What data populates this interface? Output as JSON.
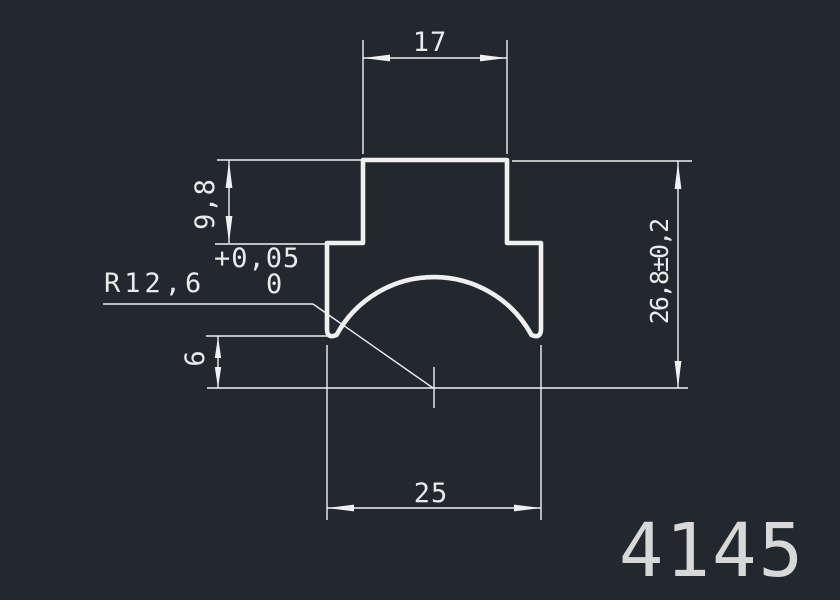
{
  "colors": {
    "background": "#23282e",
    "line": "#f0f0f0",
    "text": "#eaeaea",
    "part_number": "#d8d8d8"
  },
  "dims": {
    "top_width": "17",
    "upper_height": "9,8",
    "tol_plus": "+0,05",
    "tol_zero": "0",
    "radius": "R12,6",
    "leg_height": "6",
    "overall_height": "26,8±0,2",
    "bottom_width": "25"
  },
  "part_number": "4145"
}
